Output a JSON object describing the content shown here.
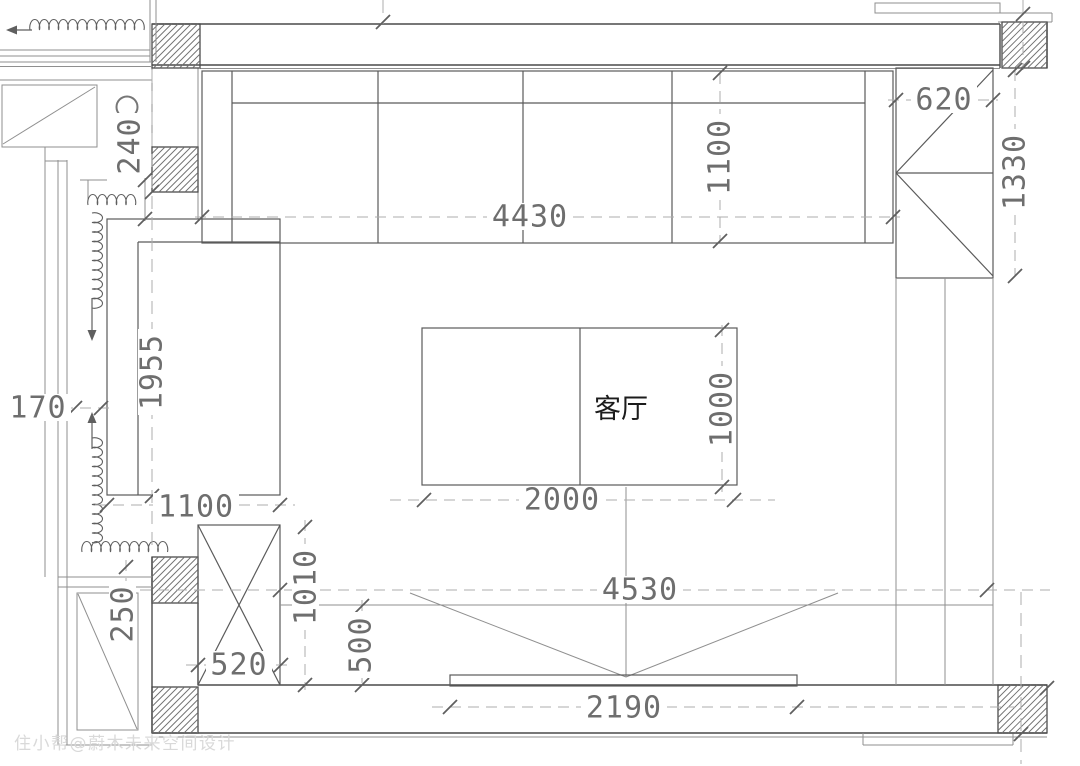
{
  "labels": {
    "room": "客厅",
    "watermark": "住小帮@蔚木未来空间设计"
  },
  "dimensions": {
    "sofa_length": "4430",
    "sofa_depth": "1100",
    "right_cabinet_width": "620",
    "right_cabinet_depth": "1330",
    "wall_offset": "240",
    "bay_length": "1955",
    "curtain_offset": "170",
    "bay_width": "1100",
    "balcony_ledge": "250",
    "left_cabinet_width": "520",
    "left_cabinet_depth": "1010",
    "tv_wall_offset": "500",
    "table_length": "2000",
    "table_width": "1000",
    "room_length": "4530",
    "console_length": "2190"
  },
  "colors": {
    "wall": "#4a4a4a",
    "furniture": "#5a5a5a",
    "light": "#8f8f8f",
    "dim_line": "#adadad",
    "tick": "#5f5f5f",
    "dim_text": "#6e6e6e",
    "label_text": "#1c1c1c",
    "watermark": "#d9d9d9",
    "background": "#ffffff"
  }
}
